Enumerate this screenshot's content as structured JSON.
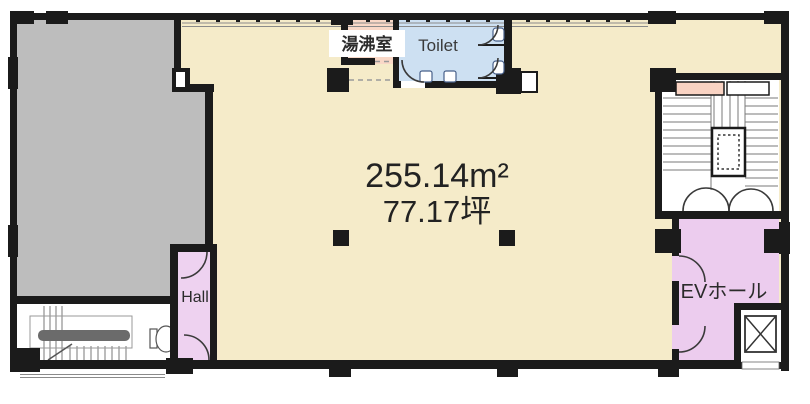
{
  "plan": {
    "title": "Floor plan",
    "labels": {
      "kitchenette": "湯沸室",
      "toilet": "Toilet",
      "area_m2": "255.14m²",
      "area_tsubo": "77.17坪",
      "hall": "Hall",
      "ev_hall": "EVホール"
    },
    "colors": {
      "main_area": "#f5ebc9",
      "adjacent_area": "#bdbdbd",
      "toilet_room": "#cde0f2",
      "kitchenette_room": "#f9d8c7",
      "hall_room": "#eed2f0",
      "ev_hall_room": "#ecccee",
      "stair_room": "#ffffff",
      "shaft_marker": "#f9d3c3",
      "wall": "#1b1b1b",
      "stair_line": "#7a7a7a",
      "door_arc": "#3a3a3a"
    }
  }
}
